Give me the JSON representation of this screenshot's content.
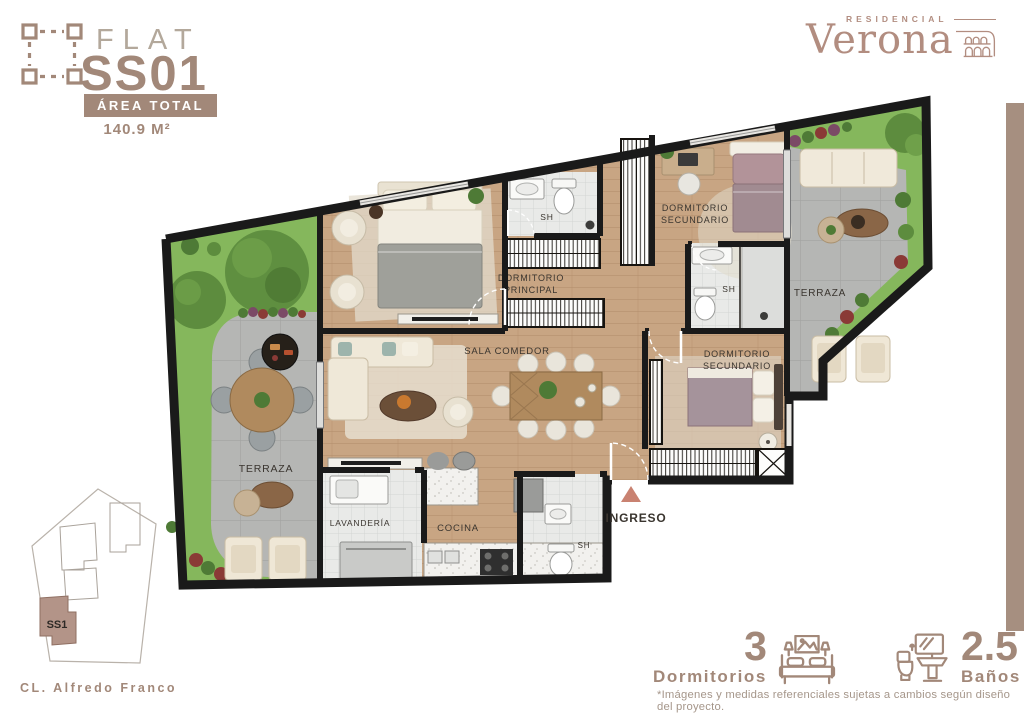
{
  "unit_card": {
    "type_label": "FLAT",
    "unit_code": "SS01",
    "area_label": "ÁREA TOTAL",
    "area_value": "140.9 M²"
  },
  "brand": {
    "pre": "RESIDENCIAL",
    "name": "Verona"
  },
  "floorplan": {
    "rooms": {
      "dormitorio_principal": {
        "line1": "DORMITORIO",
        "line2": "PRINCIPAL"
      },
      "sh_principal": "SH",
      "dormitorio_secundario_1": {
        "line1": "DORMITORIO",
        "line2": "SECUNDARIO"
      },
      "sh_secundario": "SH",
      "terraza_derecha": "TERRAZA",
      "dormitorio_secundario_2": {
        "line1": "DORMITORIO",
        "line2": "SECUNDARIO"
      },
      "sala_comedor": "SALA COMEDOR",
      "terraza_izquierda": "TERRAZA",
      "lavanderia": "LAVANDERÍA",
      "cocina": "COCINA",
      "sh_visitas": "SH",
      "ingreso": "INGRESO"
    }
  },
  "site_plan": {
    "unit_label": "SS1",
    "street": "CL. Alfredo Franco"
  },
  "stats": {
    "bedrooms": {
      "value": "3",
      "label": "Dormitorios"
    },
    "bathrooms": {
      "value": "2.5",
      "label": "Baños"
    }
  },
  "disclaimer": "*Imágenes y medidas referenciales sujetas a cambios según diseño del proyecto.",
  "colors": {
    "accent": "#a28879",
    "logo": "#b28d80",
    "entry_arrow": "#c98271",
    "grass": "#85b75c",
    "patio_gray": "#b5b6b4",
    "wood": "#c8a583",
    "wall": "#1a1a1a",
    "site_unit_fill": "#b39488",
    "right_bar": "#a68f80"
  }
}
